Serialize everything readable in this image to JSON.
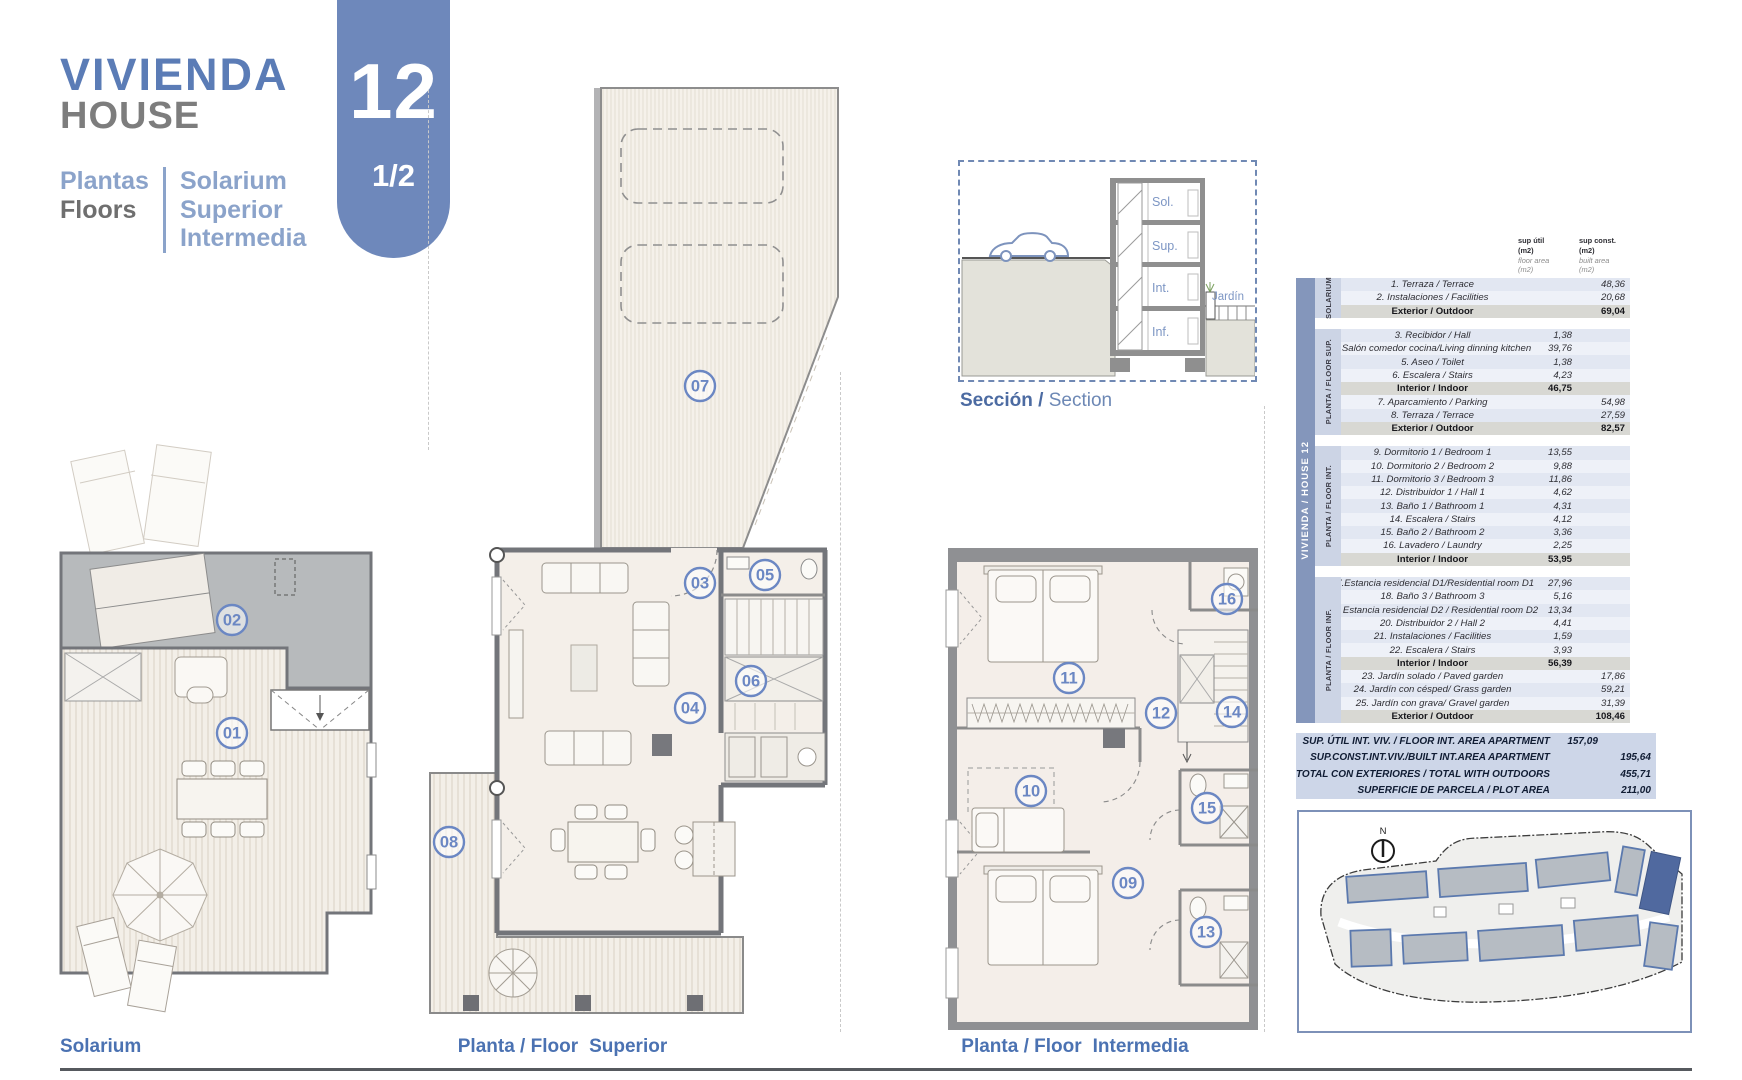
{
  "header": {
    "title": "VIVIENDA",
    "subtitle": "HOUSE",
    "floors_es": "Plantas",
    "floors_en": "Floors",
    "floor_names": [
      "Solarium",
      "Superior",
      "Intermedia"
    ],
    "badge_number": "12",
    "badge_page": "1/2"
  },
  "section_view": {
    "label_es": "Sección /",
    "label_en": "Section",
    "floor_tags": [
      "Sol.",
      "Sup.",
      "Int.",
      "Inf."
    ],
    "garden_label": "Jardín"
  },
  "site_plan": {
    "north_label": "N"
  },
  "plans": {
    "solarium": {
      "label": "Solarium",
      "markers": {
        "m01": "01",
        "m02": "02"
      }
    },
    "superior": {
      "label_prefix": "Planta / Floor",
      "label_name": "Superior",
      "markers": {
        "m03": "03",
        "m04": "04",
        "m05": "05",
        "m06": "06",
        "m07": "07",
        "m08": "08"
      }
    },
    "intermedia": {
      "label_prefix": "Planta / Floor",
      "label_name": "Intermedia",
      "markers": {
        "m09": "09",
        "m10": "10",
        "m11": "11",
        "m12": "12",
        "m13": "13",
        "m14": "14",
        "m15": "15",
        "m16": "16"
      }
    }
  },
  "table": {
    "band_label": "VIVIENDA / HOUSE 12",
    "col1_header": [
      "sup útil",
      "(m2)",
      "floor area",
      "(m2)"
    ],
    "col2_header": [
      "sup const.",
      "(m2)",
      "built area",
      "(m2)"
    ],
    "sections": [
      {
        "side_label": "SOLARIUM",
        "rows": [
          {
            "label": "1. Terraza / Terrace",
            "util": "",
            "built": "48,36"
          },
          {
            "label": "2. Instalaciones / Facilities",
            "util": "",
            "built": "20,68"
          },
          {
            "label": "Exterior / Outdoor",
            "util": "",
            "built": "69,04",
            "subtotal": true
          }
        ]
      },
      {
        "side_label": "PLANTA / FLOOR SUP.",
        "rows": [
          {
            "label": "3. Recibidor / Hall",
            "util": "1,38",
            "built": ""
          },
          {
            "label": "4 Salón comedor cocina/Living dinning kitchen",
            "util": "39,76",
            "built": ""
          },
          {
            "label": "5. Aseo / Toilet",
            "util": "1,38",
            "built": ""
          },
          {
            "label": "6. Escalera / Stairs",
            "util": "4,23",
            "built": ""
          },
          {
            "label": "Interior / Indoor",
            "util": "46,75",
            "built": "",
            "subtotal": true
          },
          {
            "label": "7. Aparcamiento / Parking",
            "util": "",
            "built": "54,98"
          },
          {
            "label": "8. Terraza / Terrace",
            "util": "",
            "built": "27,59"
          },
          {
            "label": "Exterior / Outdoor",
            "util": "",
            "built": "82,57",
            "subtotal": true
          }
        ]
      },
      {
        "side_label": "PLANTA / FLOOR INT.",
        "rows": [
          {
            "label": "9. Dormitorio 1 / Bedroom 1",
            "util": "13,55",
            "built": ""
          },
          {
            "label": "10.  Dormitorio 2 / Bedroom 2",
            "util": "9,88",
            "built": ""
          },
          {
            "label": "11.  Dormitorio 3 / Bedroom 3",
            "util": "11,86",
            "built": ""
          },
          {
            "label": "12. Distribuidor 1 / Hall 1",
            "util": "4,62",
            "built": ""
          },
          {
            "label": "13. Baño 1 / Bathroom 1",
            "util": "4,31",
            "built": ""
          },
          {
            "label": "14. Escalera / Stairs",
            "util": "4,12",
            "built": ""
          },
          {
            "label": "15. Baño 2 / Bathroom 2",
            "util": "3,36",
            "built": ""
          },
          {
            "label": "16. Lavadero / Laundry",
            "util": "2,25",
            "built": ""
          },
          {
            "label": "Interior / Indoor",
            "util": "53,95",
            "built": "",
            "subtotal": true
          }
        ]
      },
      {
        "side_label": "PLANTA / FLOOR INF.",
        "rows": [
          {
            "label": "17.Estancia residencial D1/Residential room D1",
            "util": "27,96",
            "built": ""
          },
          {
            "label": "18. Baño 3 / Bathroom 3",
            "util": "5,16",
            "built": ""
          },
          {
            "label": "19. Estancia residencial D2 / Residential room D2",
            "util": "13,34",
            "built": ""
          },
          {
            "label": "20. Distribuidor 2 / Hall 2",
            "util": "4,41",
            "built": ""
          },
          {
            "label": "21. Instalaciones / Facilities",
            "util": "1,59",
            "built": ""
          },
          {
            "label": "22. Escalera / Stairs",
            "util": "3,93",
            "built": ""
          },
          {
            "label": "Interior / Indoor",
            "util": "56,39",
            "built": "",
            "subtotal": true
          },
          {
            "label": "23. Jardín solado / Paved garden",
            "util": "",
            "built": "17,86"
          },
          {
            "label": "24. Jardín con césped/ Grass garden",
            "util": "",
            "built": "59,21"
          },
          {
            "label": "25. Jardín con grava/ Gravel garden",
            "util": "",
            "built": "31,39"
          },
          {
            "label": "Exterior / Outdoor",
            "util": "",
            "built": "108,46",
            "subtotal": true
          }
        ]
      }
    ],
    "summary": [
      {
        "label": "SUP. ÚTIL INT. VIV. / FLOOR INT. AREA APARTMENT",
        "util": "157,09",
        "built": ""
      },
      {
        "label": "SUP.CONST.INT.VIV./BUILT INT.AREA APARTMENT",
        "util": "",
        "built": "195,64"
      },
      {
        "label": "TOTAL CON EXTERIORES / TOTAL WITH OUTDOORS",
        "util": "",
        "built": "455,71"
      },
      {
        "label": "SUPERFICIE DE PARCELA / PLOT AREA",
        "util": "",
        "built": "211,00"
      }
    ]
  },
  "colors": {
    "accent_blue": "#5b7cb6",
    "badge_blue": "#6e88bb",
    "band_blue": "#8496bb",
    "marker_blue": "#6b87c3",
    "plan_label_blue": "#4b72b2",
    "highlight_building": "#50699f"
  }
}
